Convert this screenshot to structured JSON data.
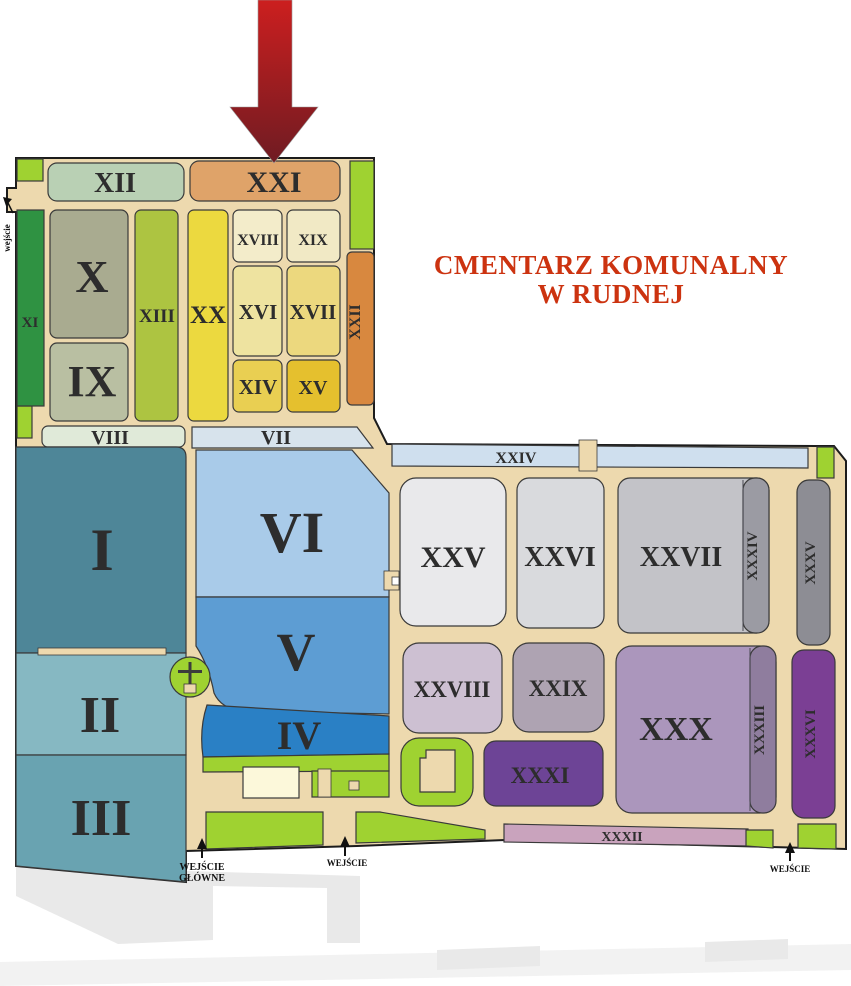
{
  "title": {
    "line1": "CMENTARZ KOMUNALNY",
    "line2": "W RUDNEJ"
  },
  "sections": {
    "s1": {
      "label": "I",
      "color": "#4e8698"
    },
    "s2": {
      "label": "II",
      "color": "#86b8c2"
    },
    "s3": {
      "label": "III",
      "color": "#69a3b1"
    },
    "s4": {
      "label": "IV",
      "color": "#2a80c5"
    },
    "s5": {
      "label": "V",
      "color": "#5d9dd3"
    },
    "s6": {
      "label": "VI",
      "color": "#a9cbe9"
    },
    "s7": {
      "label": "VII",
      "color": "#d7e3ec"
    },
    "s8": {
      "label": "VIII",
      "color": "#e0ead9"
    },
    "s9": {
      "label": "IX",
      "color": "#b9bfa2"
    },
    "s10": {
      "label": "X",
      "color": "#a9ab90"
    },
    "s11": {
      "label": "XI",
      "color": "#2f9242"
    },
    "s12": {
      "label": "XII",
      "color": "#b9d0b4"
    },
    "s13": {
      "label": "XIII",
      "color": "#adc441"
    },
    "s14": {
      "label": "XIV",
      "color": "#e9cf52"
    },
    "s15": {
      "label": "XV",
      "color": "#e5c02e"
    },
    "s16": {
      "label": "XVI",
      "color": "#eee3a0"
    },
    "s17": {
      "label": "XVII",
      "color": "#ecd87e"
    },
    "s18": {
      "label": "XVIII",
      "color": "#f3ecca"
    },
    "s19": {
      "label": "XIX",
      "color": "#f1e9c5"
    },
    "s20": {
      "label": "XX",
      "color": "#ecd93f"
    },
    "s21": {
      "label": "XXI",
      "color": "#dfa369"
    },
    "s22": {
      "label": "XXII",
      "color": "#d8883f"
    },
    "s24": {
      "label": "XXIV",
      "color": "#cfdfee"
    },
    "s25": {
      "label": "XXV",
      "color": "#e9e9eb"
    },
    "s26": {
      "label": "XXVI",
      "color": "#d9dadd"
    },
    "s27": {
      "label": "XXVII",
      "color": "#c3c3c8"
    },
    "s28": {
      "label": "XXVIII",
      "color": "#cdc0d2"
    },
    "s29": {
      "label": "XXIX",
      "color": "#aea3b2"
    },
    "s30": {
      "label": "XXX",
      "color": "#ab96bc"
    },
    "s31": {
      "label": "XXXI",
      "color": "#6d4496"
    },
    "s32": {
      "label": "XXXII",
      "color": "#c9a3bd"
    },
    "s33": {
      "label": "XXXIII",
      "color": "#8f7d9e"
    },
    "s34": {
      "label": "XXXIV",
      "color": "#9b9ba3"
    },
    "s35": {
      "label": "XXXV",
      "color": "#8d8d94"
    },
    "s36": {
      "label": "XXXVI",
      "color": "#7b3f94"
    }
  },
  "entrances": {
    "left_vertical": {
      "label": "wejście"
    },
    "main": {
      "line1": "WEJŚCIE",
      "line2": "GŁÓWNE"
    },
    "middle": {
      "label": "WEJŚCIE"
    },
    "right": {
      "label": "WEJŚCIE"
    }
  },
  "colors": {
    "path": "#edd9ae",
    "grass": "#9fd231",
    "road": "#e9e9e9",
    "road_faint": "#f2f2f2",
    "building": "#fcf8da",
    "label": "#2d2d2d",
    "title": "#cc3310",
    "arrow_top": "#cc1f1f",
    "arrow_bottom": "#6f1b22",
    "cross": "#3c3c3c",
    "entrance_text": "#111111"
  }
}
